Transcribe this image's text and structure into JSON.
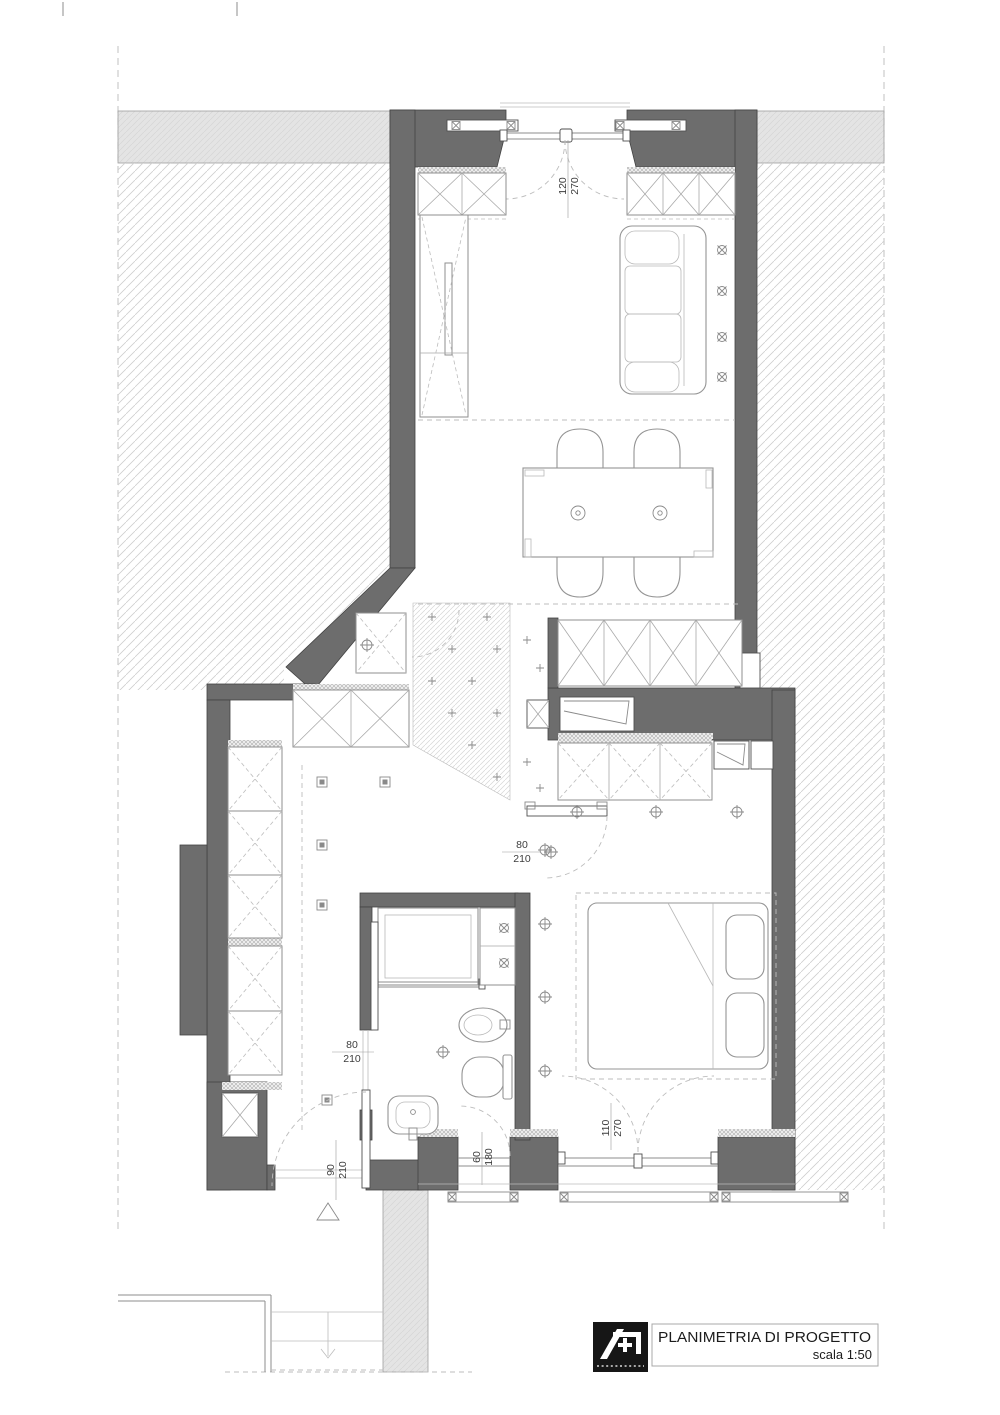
{
  "title_block": {
    "title": "PLANIMETRIA DI PROGETTO",
    "scale": "scala 1:50"
  },
  "dimension_labels": {
    "balcony_door": {
      "w": "120",
      "h": "270"
    },
    "bedroom_window": {
      "w": "110",
      "h": "270"
    },
    "bathroom_window": {
      "w": "60",
      "h": "180"
    },
    "entry_door": {
      "w": "90",
      "h": "210"
    },
    "bathroom_door": {
      "w": "80",
      "h": "210"
    },
    "bedroom_door": {
      "w": "80",
      "h": "210"
    }
  },
  "colors": {
    "wall": "#6d6d6d",
    "paper": "#ffffff",
    "context_band": "#e4e4e4",
    "logo_bg": "#161616",
    "line_dark": "#424242",
    "line_mid": "#8e8e8e",
    "line_light": "#bdbdbd",
    "text": "#3d3d3d"
  }
}
